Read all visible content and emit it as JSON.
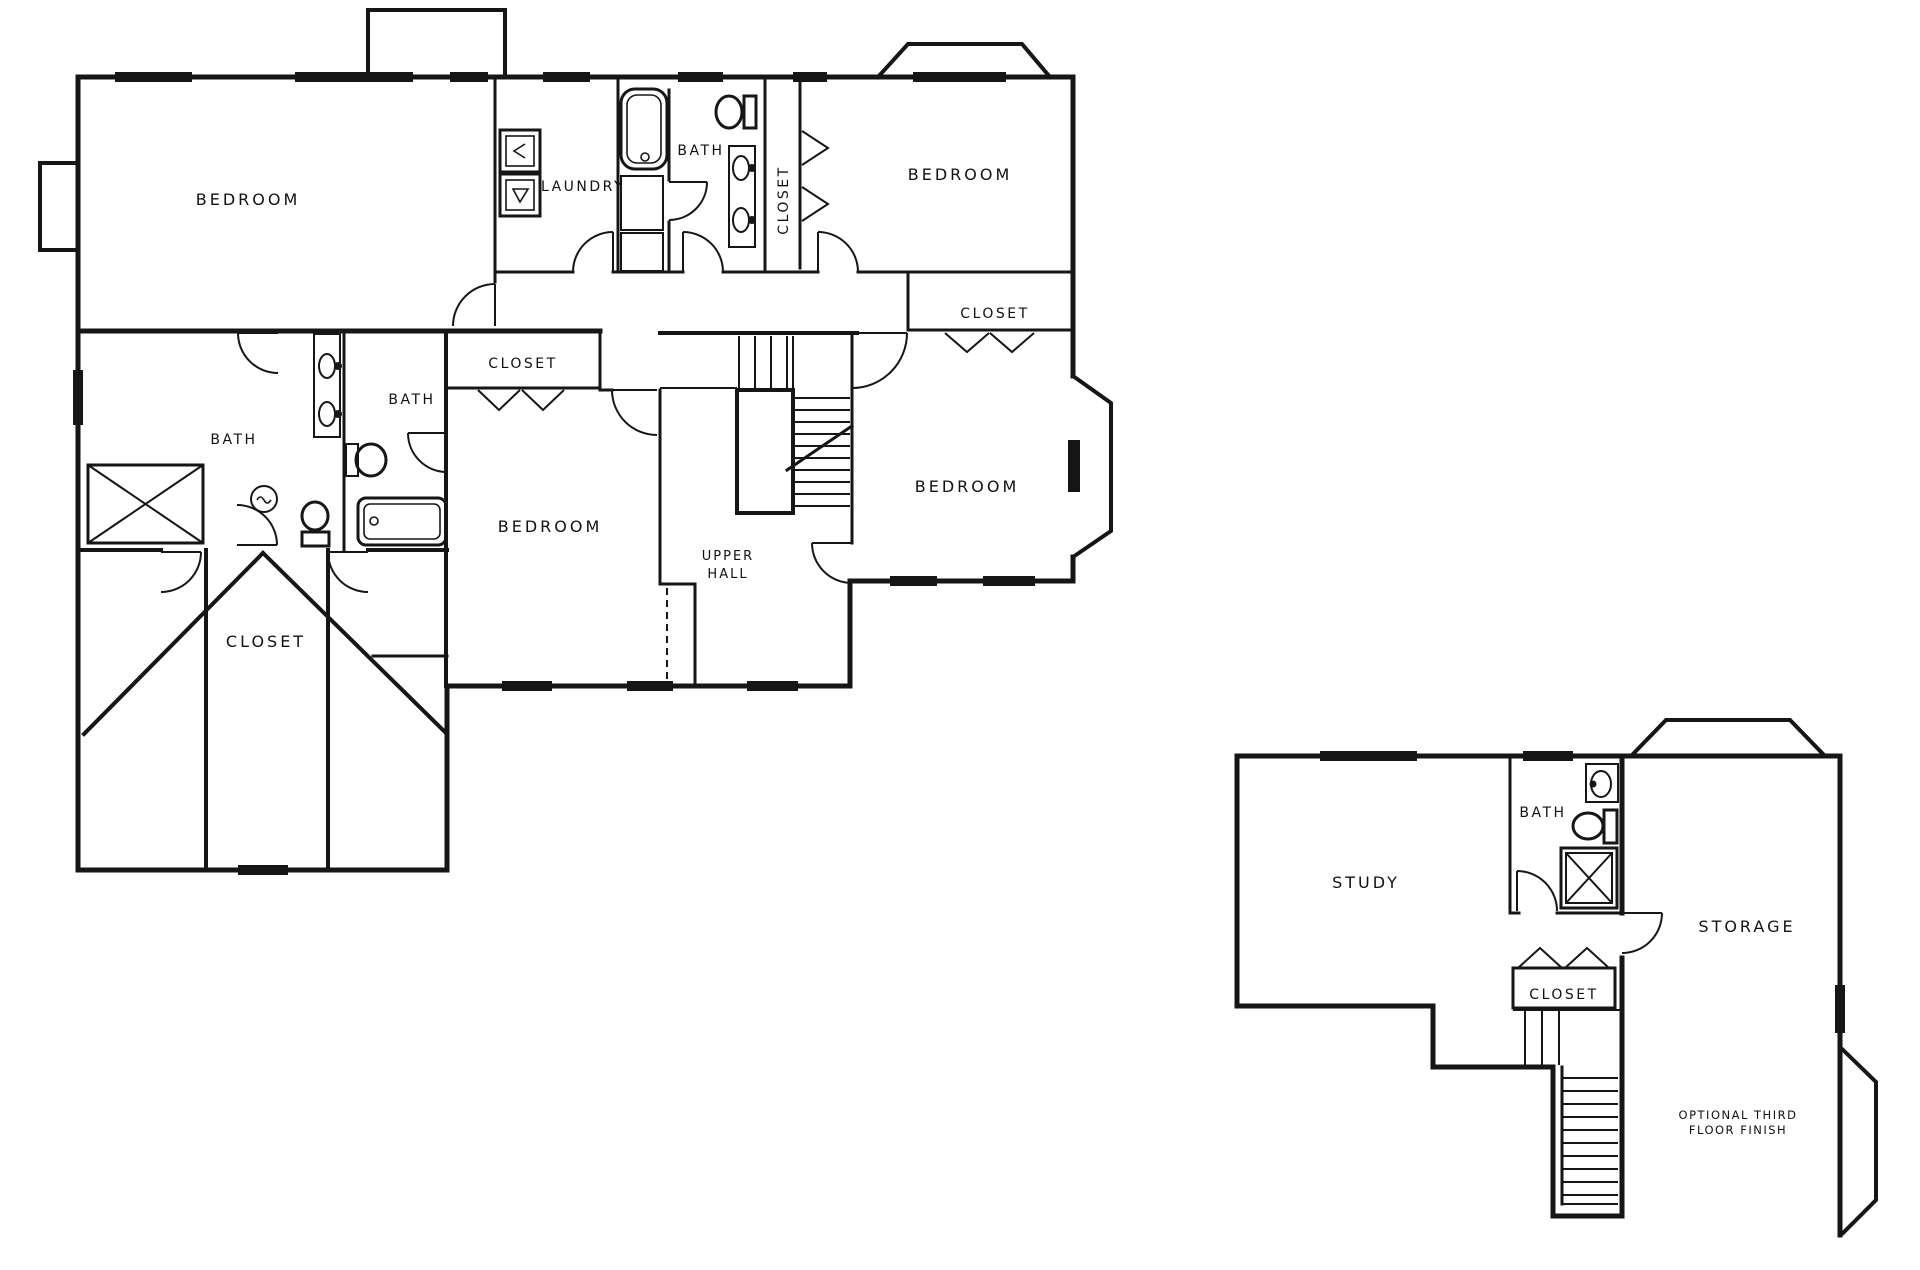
{
  "page": {
    "background": "#ffffff",
    "line_color": "#161616",
    "text_color": "#111111",
    "description": "Second floor and optional third floor architectural plan"
  },
  "main_floor": {
    "bedroom_top_left": "BEDROOM",
    "laundry": "LAUNDRY",
    "bath_top": "BATH",
    "closet_hall_vertical": "CLOSET",
    "bedroom_top_right": "BEDROOM",
    "closet_top_right": "CLOSET",
    "bath_left": "BATH",
    "bath_small": "BATH",
    "closet_center": "CLOSET",
    "bedroom_center": "BEDROOM",
    "upper_hall_line1": "UPPER",
    "upper_hall_line2": "HALL",
    "bedroom_right": "BEDROOM",
    "closet_walk_in": "CLOSET"
  },
  "third_floor": {
    "study": "STUDY",
    "bath": "BATH",
    "closet": "CLOSET",
    "storage": "STORAGE",
    "note_line1": "OPTIONAL THIRD",
    "note_line2": "FLOOR FINISH"
  }
}
